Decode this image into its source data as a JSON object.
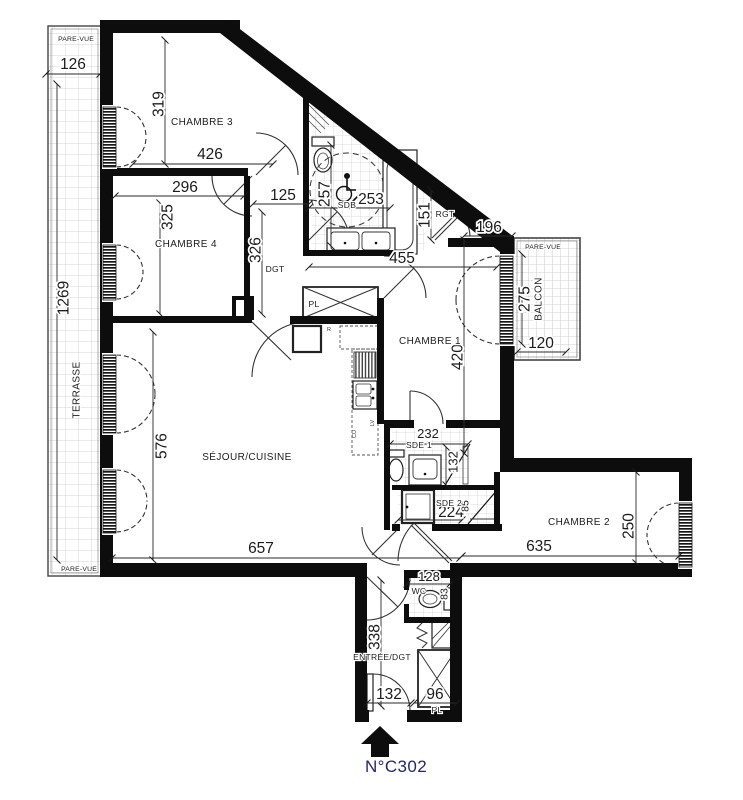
{
  "unit": {
    "number": "N°C302"
  },
  "colors": {
    "wall": "#0d0d0d",
    "unit_text": "#23266b",
    "dim_text": "#1c1c1c"
  },
  "rooms": {
    "chambre1": "CHAMBRE 1",
    "chambre2": "CHAMBRE 2",
    "chambre3": "CHAMBRE 3",
    "chambre4": "CHAMBRE 4",
    "sejour": "SÉJOUR/CUISINE",
    "sdb": "SDB",
    "sde1": "SDE 1",
    "sde2": "SDE 2",
    "wc": "WC",
    "entree": "ENTRÉE/DGT",
    "dgt": "DGT",
    "rgt": "RGT",
    "pl": "PL",
    "terrasse": "TERRASSE",
    "balcon": "BALCON"
  },
  "annotations": {
    "pare_vue": "PARE-VUE",
    "fridge": "R",
    "dishwasher": "LV",
    "hob": "CU"
  },
  "dimensions_cm": {
    "terrasse_depth": "126",
    "terrasse_length": "1269",
    "chambre3_h": "319",
    "chambre3_w": "426",
    "chambre4_w": "296",
    "chambre4_h": "325",
    "dgt_w": "125",
    "dgt_h": "326",
    "sdb_h": "257",
    "sdb_w": "253",
    "sdb_bath": "151",
    "rgt_w": "196",
    "hall_w": "455",
    "chambre1_h": "420",
    "balcon_h": "275",
    "balcon_w": "120",
    "sejour_h": "576",
    "sejour_w": "657",
    "sde1_w": "232",
    "sde1_h": "132",
    "sde2_w": "224",
    "sde2_h": "85",
    "chambre2_w": "635",
    "chambre2_h": "250",
    "wc_w": "128",
    "wc_h": "83",
    "entree_h": "338",
    "entree_w": "132",
    "pl_w": "96"
  }
}
